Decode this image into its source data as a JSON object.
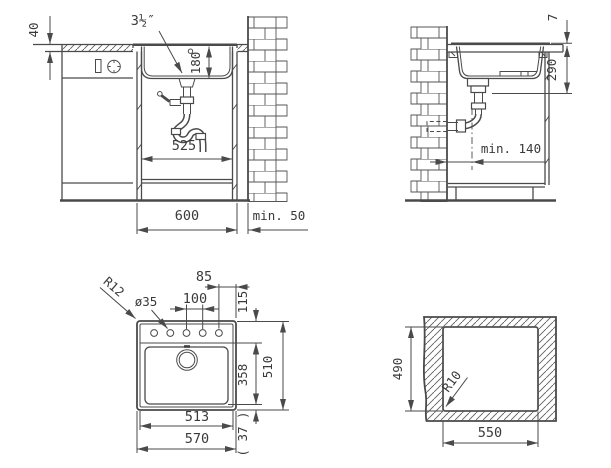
{
  "drawing": {
    "front": {
      "counter_thickness": "40",
      "drain_size": "3½″",
      "bowl_depth": "180",
      "cabinet_inner_width": "525",
      "cabinet_width": "600",
      "wall_clearance": "min. 50"
    },
    "side": {
      "rim_height": "7",
      "overall_depth": "290",
      "drain_wall_distance": "min. 140"
    },
    "plan": {
      "edge_to_hole": "85",
      "hole_spacing": "100",
      "front_deck": "115",
      "hole_diameter": "ø35",
      "corner_radius": "R12",
      "bowl_length": "358",
      "overall_depth": "510",
      "rear_gap": "( 37 )",
      "inner_width": "513",
      "overall_width": "570"
    },
    "cutout": {
      "depth": "490",
      "corner_radius": "R10",
      "width": "550"
    },
    "palette": {
      "line": "#4a4a4a",
      "text": "#3a3a3a",
      "background": "#ffffff"
    }
  }
}
